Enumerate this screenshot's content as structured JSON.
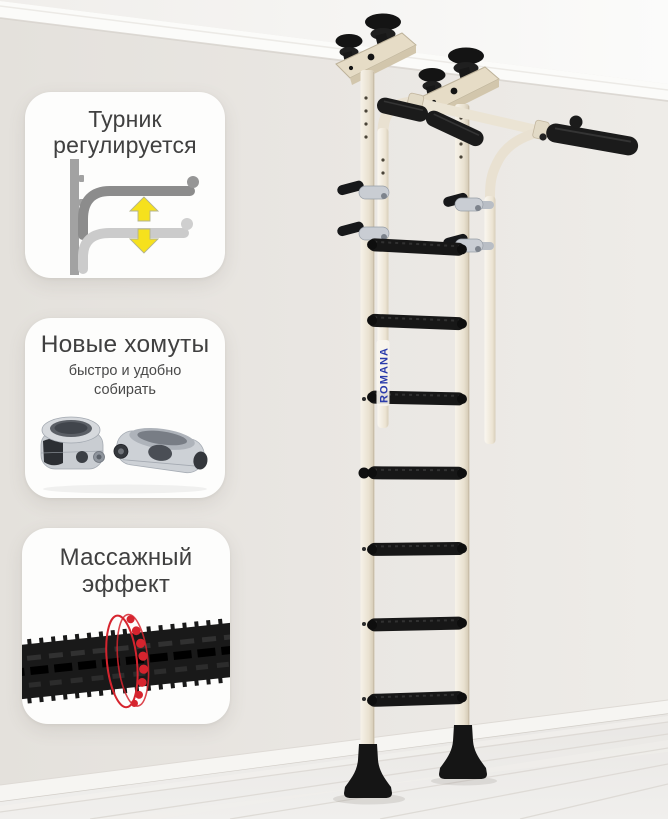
{
  "brand": {
    "logo_text": "ROMANA",
    "logo_color": "#2b3cab"
  },
  "callouts": [
    {
      "title": "Турник регулируется",
      "subtitle": "",
      "illustration": "adjustable-pullup-bar-diagram",
      "accent_color": "#f6e11d"
    },
    {
      "title": "Новые хомуты",
      "subtitle": "быстро и удобно собирать",
      "illustration": "quick-assembly-clamps-render"
    },
    {
      "title": "Массажный эффект",
      "subtitle": "",
      "illustration": "massage-textured-rung-with-red-rings",
      "accent_color": "#d6242e"
    }
  ],
  "colors": {
    "wall": "#e8e5e1",
    "ceiling": "#fafaf8",
    "floor": "#edecea",
    "frame_cream": "#ebe3d3",
    "rubber_black": "#171717",
    "callout_bg": "#fdfdfc",
    "title_text": "#404040",
    "arrow_yellow": "#f6e11d",
    "ring_red": "#d6242e",
    "logo_blue": "#2b3cab"
  }
}
